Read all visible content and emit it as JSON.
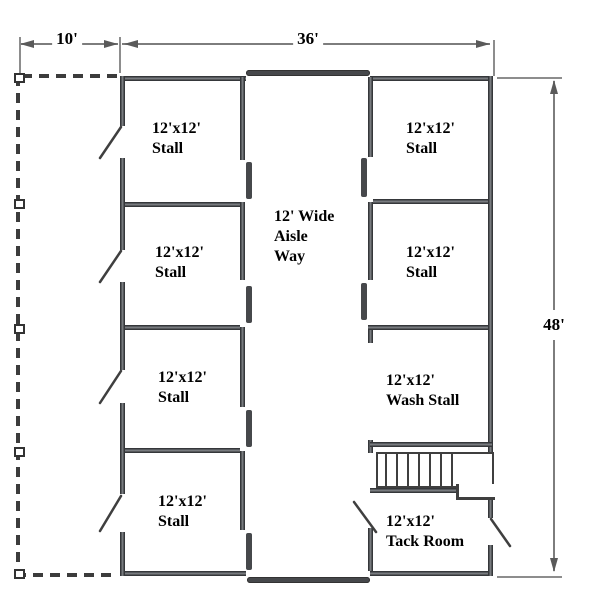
{
  "dimensions": {
    "overhang_width": "10'",
    "barn_width": "36'",
    "barn_length": "48'"
  },
  "aisle": {
    "line1": "12' Wide",
    "line2": "Aisle",
    "line3": "Way"
  },
  "rooms": [
    {
      "size": "12'x12'",
      "name": "Stall"
    },
    {
      "size": "12'x12'",
      "name": "Stall"
    },
    {
      "size": "12'x12'",
      "name": "Stall"
    },
    {
      "size": "12'x12'",
      "name": "Stall"
    },
    {
      "size": "12'x12'",
      "name": "Stall"
    },
    {
      "size": "12'x12'",
      "name": "Stall"
    },
    {
      "size": "12'x12'",
      "name": "Wash Stall"
    },
    {
      "size": "12'x12'",
      "name": "Tack Room"
    }
  ],
  "colors": {
    "wall": "#4e5053",
    "dimension_line": "#7d7d7d",
    "dashed_line": "#3c3c3c",
    "text": "#000000",
    "background": "#ffffff"
  }
}
